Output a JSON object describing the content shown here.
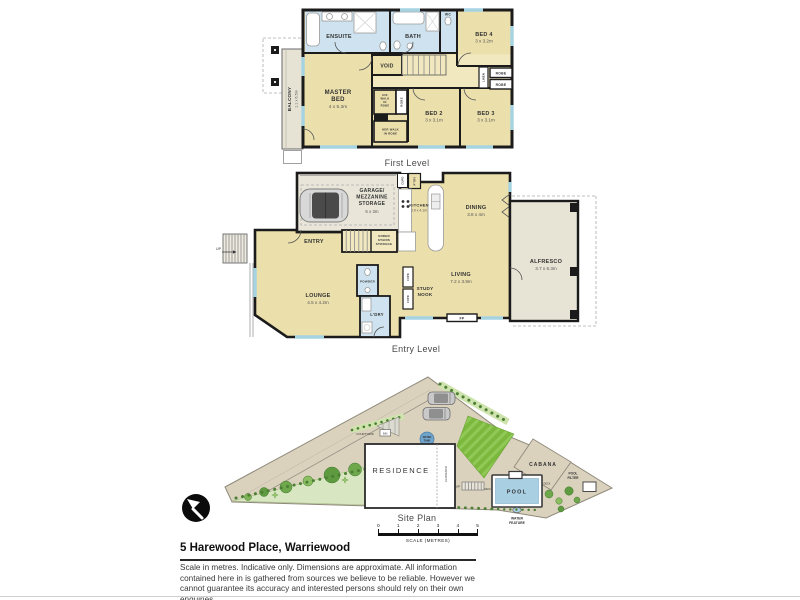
{
  "page": {
    "address": "5 Harewood Place, Warriewood",
    "disclaimer": [
      "Scale in metres. Indicative only. Dimensions are approximate. All information",
      "contained here in is gathered from sources we believe to be reliable. However we",
      "cannot guarantee its accuracy and interested persons should rely on their own enquiries."
    ],
    "scale": {
      "ticks": [
        "0",
        "1",
        "2",
        "3",
        "4",
        "5"
      ],
      "label": "SCALE (METRES)"
    }
  },
  "first": {
    "label": "First Level",
    "rooms": {
      "ensuite": "ENSUITE",
      "bath": "BATH",
      "wc": "WC",
      "bed4": "BED 4",
      "bed4_dims": "3 x 3.2m",
      "void": "VOID",
      "master": [
        "MASTER",
        "BED"
      ],
      "master_dims": "4 x 5.3m",
      "his": [
        "HIS",
        "WALK",
        "IN",
        "ROBE"
      ],
      "robe_v": "ROBE",
      "her": [
        "HER WALK",
        "IN ROBE"
      ],
      "linen": "LINEN",
      "robe_a": "ROBE",
      "robe_b": "ROBE",
      "bed2": "BED 2",
      "bed2_dims": "3 x 3.1m",
      "bed3": "BED 3",
      "bed3_dims": "3 x 3.1m",
      "balcony": "BALCONY",
      "balcony_dims": "1.1 x 6.5m"
    }
  },
  "entry": {
    "label": "Entry Level",
    "rooms": {
      "garage": [
        "GARAGE/",
        "MEZZANINE",
        "STORAGE"
      ],
      "garage_dims": "6 x 3m",
      "cupd": "CUPD",
      "pantry": "P'TRY",
      "kitchen": "KITCHEN",
      "kitchen_dims": "2.9 x 4.1m",
      "dining": "DINING",
      "dining_dims": "3.8 x 4m",
      "entry": "ENTRY",
      "storage": [
        "UNDER",
        "STAIRS",
        "STORAGE"
      ],
      "lounge": "LOUNGE",
      "lounge_dims": "4.5 x 4.2m",
      "powder": "POWDER",
      "laundry": "L'DRY",
      "study": [
        "STUDY",
        "NOOK"
      ],
      "cupd_a": "CUPD",
      "cupd_b": "CUPD",
      "living": "LIVING",
      "living_dims": "7.2 x 3.9m",
      "fp": "FP",
      "alfresco": "ALFRESCO",
      "alfresco_dims": "3.7 x 6.3m",
      "up": "UP"
    }
  },
  "site": {
    "label": "Site Plan",
    "labels": {
      "residence": "RESIDENCE",
      "alfresco": "ALFRESCO",
      "courtyard": "COURTYARD",
      "bin": "BIN",
      "water_tank": [
        "WATER",
        "TANK"
      ],
      "cabana": "CABANA",
      "pool": "POOL",
      "deck_a": "DECK",
      "deck_b": "DECK",
      "water_feature": [
        "WATER",
        "FEATURE"
      ],
      "pool_filter": [
        "POOL",
        "FILTER"
      ],
      "up": "UP"
    }
  }
}
